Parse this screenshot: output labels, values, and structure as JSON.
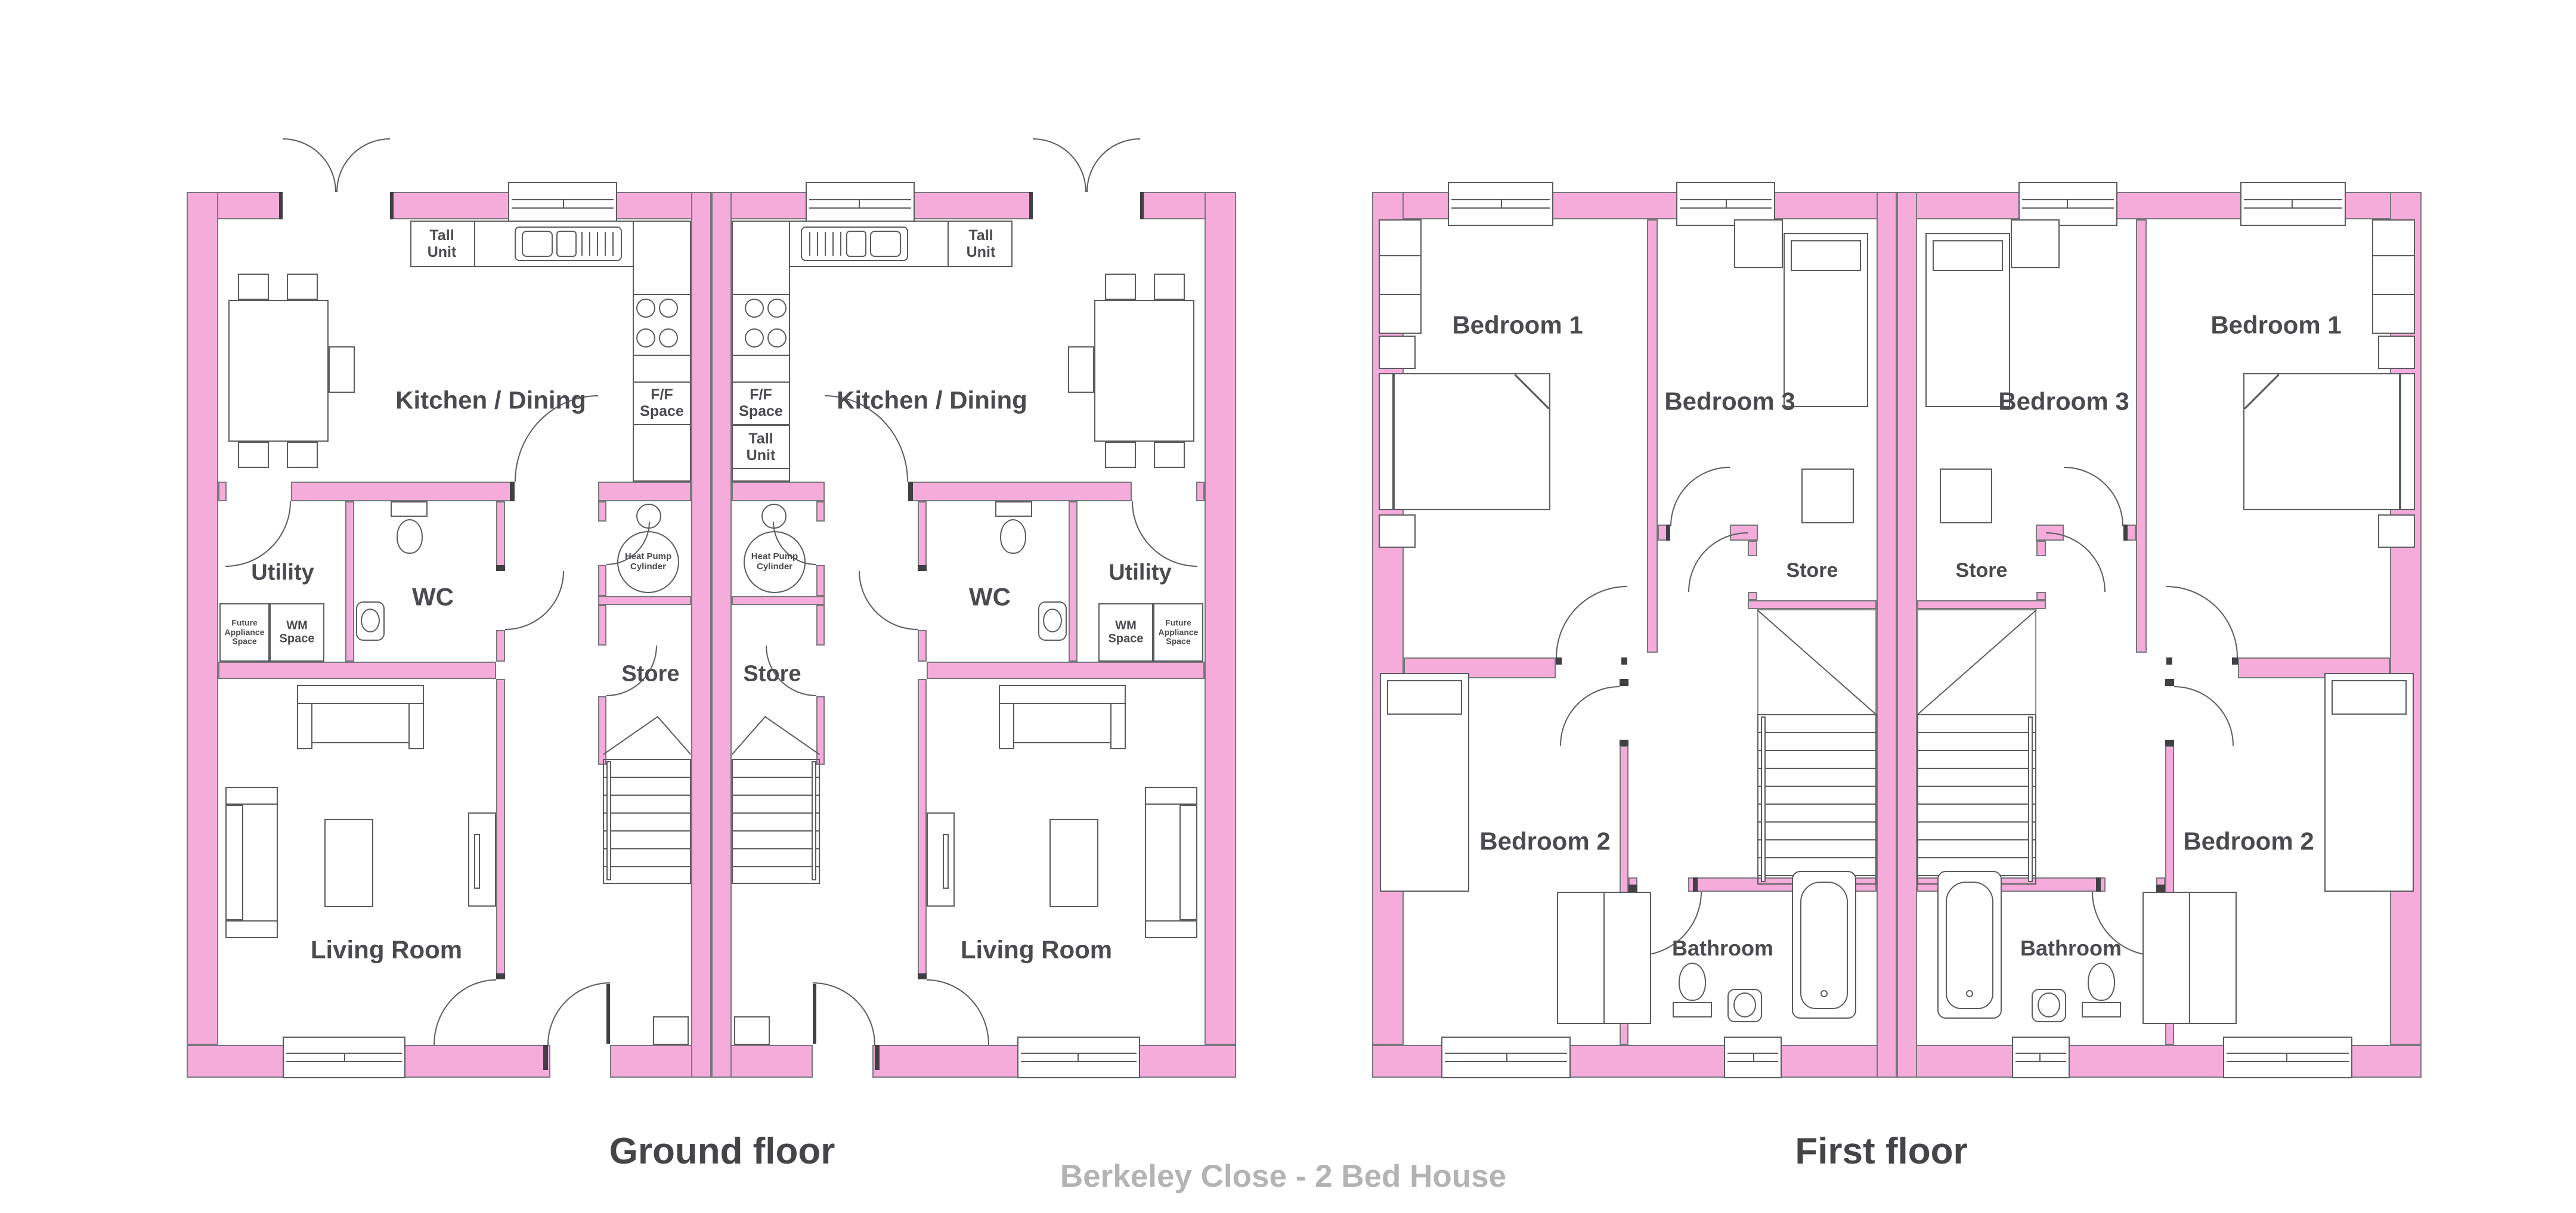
{
  "captions": {
    "ground": "Ground floor",
    "first": "First floor",
    "project": "Berkeley Close - 2 Bed House"
  },
  "ground_rooms": {
    "kitchen": "Kitchen / Dining",
    "tall_unit": "Tall Unit",
    "ff_space": "F/F Space",
    "utility": "Utility",
    "wc": "WC",
    "future_appliance": "Future Appliance Space",
    "wm_space": "WM Space",
    "heat_pump": "Heat Pump Cylinder",
    "store": "Store",
    "living": "Living Room"
  },
  "first_rooms": {
    "bedroom1": "Bedroom 1",
    "bedroom2": "Bedroom 2",
    "bedroom3": "Bedroom 3",
    "store": "Store",
    "bathroom": "Bathroom"
  },
  "colors": {
    "wall_pink": "#f6acdb",
    "wall_edge": "#77777c",
    "line_gray": "#5b5b60",
    "label_gray": "#4a4b50",
    "muted_gray": "#b3b3b6"
  },
  "house_type": "2 Bed House",
  "units_per_plan": 2
}
